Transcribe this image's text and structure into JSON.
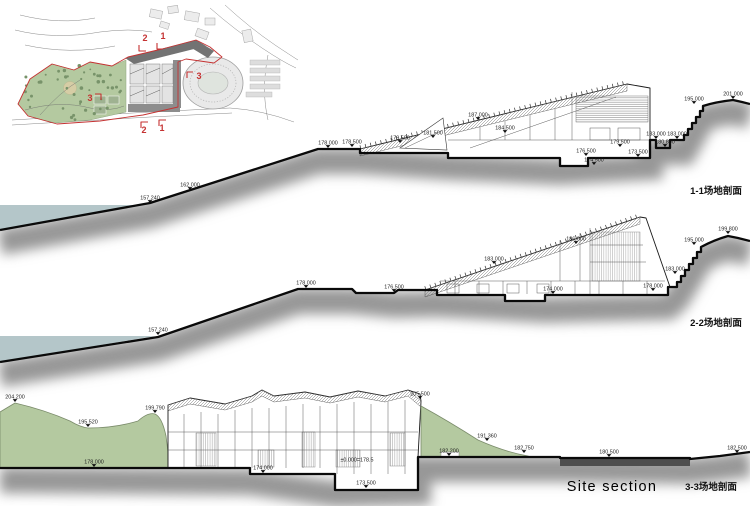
{
  "colors": {
    "water": "#b4c6c9",
    "hill": "#b4c9a0",
    "tree": "#78936a",
    "road": "#4e4e4e",
    "red": "#c53232",
    "ink": "#111111"
  },
  "site_plan": {
    "markers": [
      {
        "text": "2",
        "x": 145,
        "y": 41
      },
      {
        "text": "1",
        "x": 163,
        "y": 39
      },
      {
        "text": "3",
        "x": 90,
        "y": 101
      },
      {
        "text": "3",
        "x": 199,
        "y": 79
      },
      {
        "text": "2",
        "x": 144,
        "y": 133
      },
      {
        "text": "1",
        "x": 162,
        "y": 131
      }
    ]
  },
  "sections": [
    {
      "id": "1-1",
      "title": "1-1场地剖面",
      "labels": [
        {
          "text": "157.240",
          "x": 150,
          "y": 203
        },
        {
          "text": "162.000",
          "x": 190,
          "y": 190
        },
        {
          "text": "178.000",
          "x": 328,
          "y": 148
        },
        {
          "text": "178.500",
          "x": 352,
          "y": 147
        },
        {
          "text": "179.500",
          "x": 400,
          "y": 143
        },
        {
          "text": "181.500",
          "x": 433,
          "y": 138
        },
        {
          "text": "187.000",
          "x": 478,
          "y": 120
        },
        {
          "text": "184.500",
          "x": 505,
          "y": 133
        },
        {
          "text": "176.500",
          "x": 586,
          "y": 156
        },
        {
          "text": "174.500",
          "x": 594,
          "y": 165
        },
        {
          "text": "179.500",
          "x": 620,
          "y": 147
        },
        {
          "text": "173.500",
          "x": 638,
          "y": 157
        },
        {
          "text": "183.000",
          "x": 656,
          "y": 139
        },
        {
          "text": "180.800",
          "x": 665,
          "y": 147
        },
        {
          "text": "183.000",
          "x": 677,
          "y": 139
        },
        {
          "text": "195.000",
          "x": 694,
          "y": 104
        },
        {
          "text": "201.000",
          "x": 733,
          "y": 99
        }
      ]
    },
    {
      "id": "2-2",
      "title": "2-2场地剖面",
      "labels": [
        {
          "text": "157.240",
          "x": 158,
          "y": 335
        },
        {
          "text": "178.000",
          "x": 306,
          "y": 288
        },
        {
          "text": "176.500",
          "x": 394,
          "y": 292
        },
        {
          "text": "183.000",
          "x": 494,
          "y": 264
        },
        {
          "text": "186.000",
          "x": 576,
          "y": 244
        },
        {
          "text": "174.000",
          "x": 553,
          "y": 294
        },
        {
          "text": "178.000",
          "x": 653,
          "y": 291
        },
        {
          "text": "183.000",
          "x": 675,
          "y": 274
        },
        {
          "text": "195.000",
          "x": 694,
          "y": 245
        },
        {
          "text": "199.800",
          "x": 728,
          "y": 234
        }
      ]
    },
    {
      "id": "3-3",
      "title": "3-3场地剖面",
      "caption": "Site section",
      "labels": [
        {
          "text": "204.200",
          "x": 15,
          "y": 402
        },
        {
          "text": "195.520",
          "x": 88,
          "y": 427
        },
        {
          "text": "199.790",
          "x": 155,
          "y": 413
        },
        {
          "text": "178.000",
          "x": 94,
          "y": 467
        },
        {
          "text": "174.000",
          "x": 263,
          "y": 473
        },
        {
          "text": "±0.000=178.5",
          "x": 357,
          "y": 465,
          "tri": 0
        },
        {
          "text": "173.500",
          "x": 366,
          "y": 488
        },
        {
          "text": "205.500",
          "x": 420,
          "y": 399
        },
        {
          "text": "191.360",
          "x": 487,
          "y": 441
        },
        {
          "text": "182.200",
          "x": 449,
          "y": 456
        },
        {
          "text": "182.750",
          "x": 524,
          "y": 453
        },
        {
          "text": "180.500",
          "x": 609,
          "y": 457
        },
        {
          "text": "182.500",
          "x": 737,
          "y": 453
        }
      ]
    }
  ]
}
